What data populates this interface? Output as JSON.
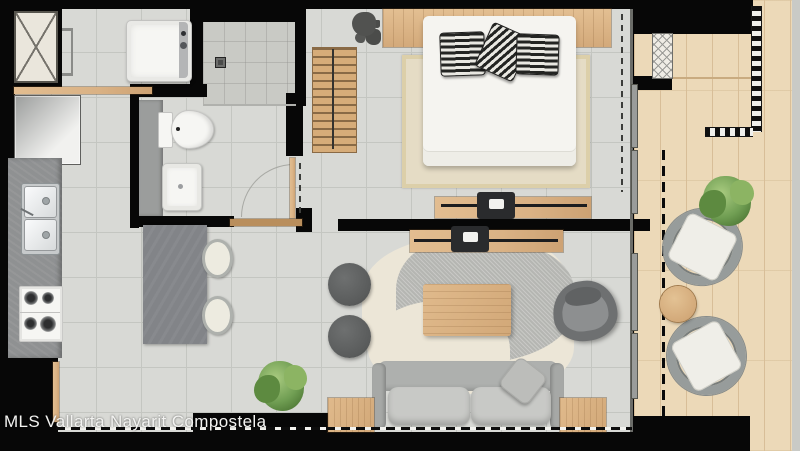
{
  "watermark": {
    "text": "MLS Vallarta Nayarit Compostela"
  },
  "colors": {
    "wall": "#070707",
    "tile": "#d8d9d5",
    "tile-line": "#c4c6c1",
    "shower": "#c9cac5",
    "deck": "#ecd9b8",
    "deck-line": "#d8be98",
    "wood": "#dab285",
    "wood-dark": "#b98e5c",
    "counter": "#8f9192",
    "island": "#828488",
    "appliance-white": "#f6f6f3",
    "sofa": "#aeb0ae",
    "cushion": "#c8c9c6",
    "pouf": "#595b5b",
    "armchair": "#6e7071",
    "rug-beige": "#e5dcc5",
    "rug-cream": "#ece6d7",
    "rug-gray": "#b5b6b2",
    "plant": "#6f9d52",
    "vanity": "#9b9d9c",
    "watermark": "#f3f3f1"
  },
  "fixtures": [
    "elevator-shaft",
    "washing-machine",
    "shower",
    "shower-drain",
    "toilet",
    "bathroom-sink",
    "refrigerator",
    "kitchen-counter",
    "kitchen-sink",
    "gas-stove",
    "kitchen-island",
    "bar-stool",
    "wardrobe-bench",
    "double-bed",
    "bed-pillows",
    "headboard",
    "bedroom-rug",
    "tv-console-bedroom",
    "tv-console-living",
    "sofa",
    "throw-pillow",
    "coffee-table",
    "living-rug",
    "armchair",
    "pouf",
    "side-table",
    "potted-plant",
    "balcony-deck",
    "balcony-railing",
    "outdoor-wicker-chair",
    "outdoor-round-table",
    "sliding-door",
    "window-line",
    "door-swing-arc"
  ]
}
